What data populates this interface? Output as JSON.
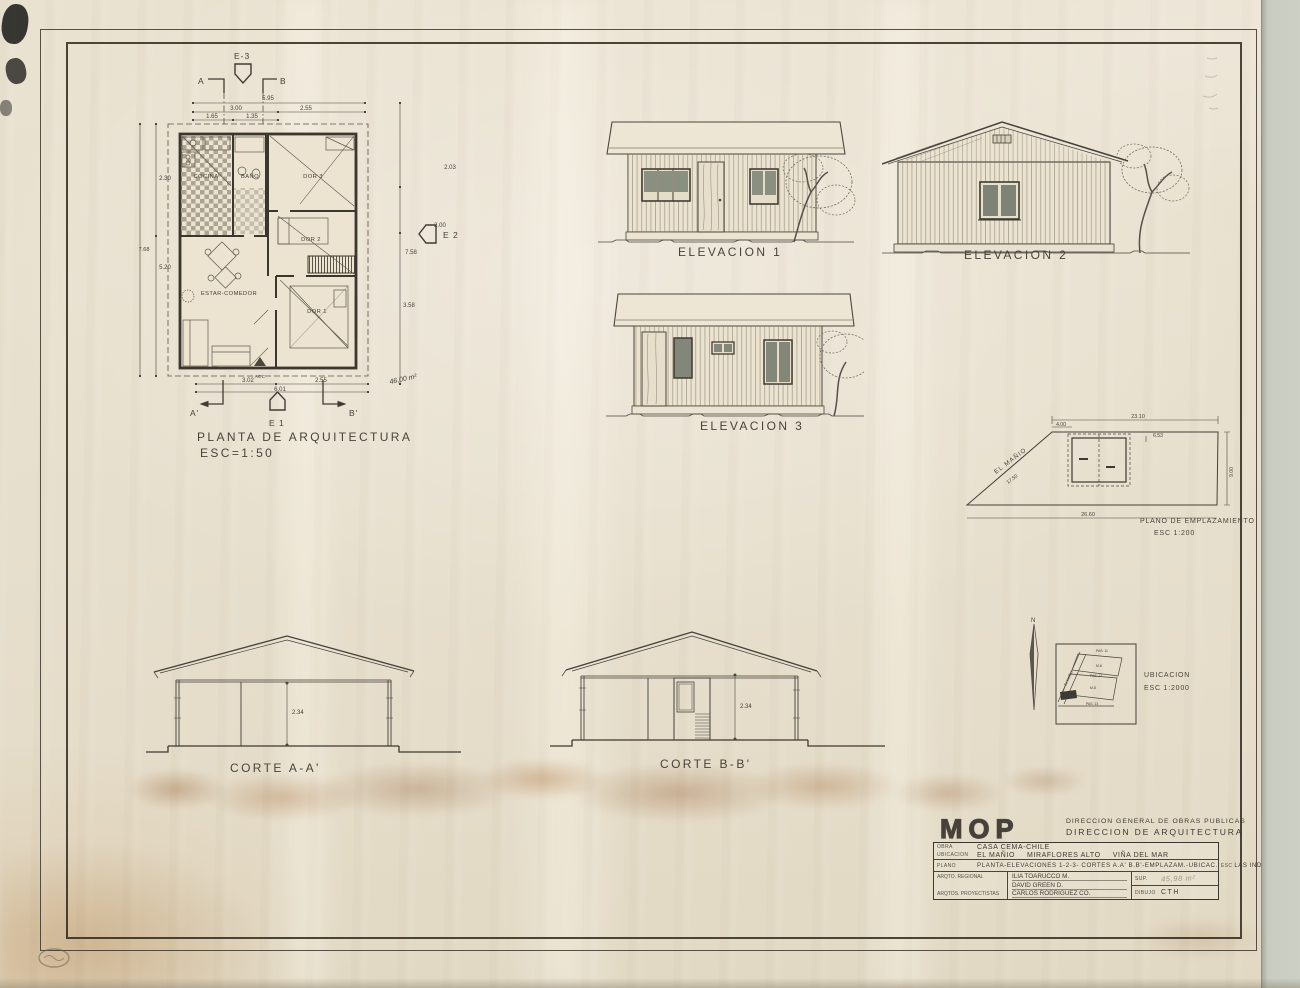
{
  "floor_plan": {
    "title": "PLANTA DE ARQUITECTURA",
    "scale": "ESC=1:50",
    "markers": {
      "e3": "E-3",
      "e2": "E 2",
      "e1": "E 1",
      "a": "A",
      "b": "B",
      "a2": "A'",
      "b2": "B'"
    },
    "rooms": {
      "cocina": "COCINA",
      "bano": "BAÑO",
      "dor3": "DOR 3",
      "dor2": "DOR 2",
      "dor1": "DOR 1",
      "estar": "ESTAR-COMEDOR",
      "acc": "ACC"
    },
    "dims": {
      "t_overall": "5.95",
      "t_left": "3.00",
      "t_right": "2.55",
      "t_s1": "1.65",
      "t_s2": "1.35",
      "l1": "2.30",
      "l2": "5.20",
      "l_overall": "7.68",
      "r1": "2.03",
      "r2": "2.00",
      "r_mid": "7.58",
      "r3": "3.58",
      "b1": "3.02",
      "b2": "2.55",
      "b_overall": "6.01"
    },
    "pencil_area": "46,00 m²"
  },
  "elevations": [
    {
      "label": "ELEVACION 1"
    },
    {
      "label": "ELEVACION 2"
    },
    {
      "label": "ELEVACION 3"
    }
  ],
  "sections": [
    {
      "label": "CORTE A-A'",
      "height": "2.34"
    },
    {
      "label": "CORTE B-B'",
      "height": "2.34"
    }
  ],
  "site_plan": {
    "title": "PLANO DE EMPLAZAMIENTO",
    "scale": "ESC 1:200",
    "street": "EL MAÑIO",
    "street_dim": "17.50",
    "dim_top": "23.10",
    "dim_seg": "4.00",
    "dim_house": "6.53",
    "dim_right": "9.00",
    "dim_bottom": "26.60"
  },
  "ubicacion": {
    "title": "UBICACION",
    "scale": "ESC 1:2000",
    "north": "N",
    "street": "EL MAÑIO",
    "pas11": "PAS. 11",
    "pas12": "PAS. 12",
    "pas13": "PAS. 13",
    "m6": "M-6",
    "m8": "M-8"
  },
  "title_block": {
    "logo": "MOP",
    "agency1": "DIRECCION GENERAL DE OBRAS PUBLICAS",
    "agency2": "DIRECCION DE ARQUITECTURA",
    "obra_label": "OBRA",
    "obra": "CASA CEMA-CHILE",
    "ubicacion_label": "UBICACION",
    "ubicacion_parts": [
      "EL MAÑIO",
      "MIRAFLORES ALTO",
      "VIÑA DEL MAR"
    ],
    "plano_label": "PLANO",
    "plano": "PLANTA-ELEVACIONES 1-2-3- CORTES A.A' B.B'-EMPLAZAM.-UBICAC.",
    "esc_label": "ESC",
    "esc": "LAS INDICADAS",
    "role1": "ARQTO. REGIONAL",
    "role2": "ARQTOS. PROYECTISTAS",
    "names": [
      "ILIA TOARUCCO M.",
      "DAVID GREEN D.",
      "CARLOS RODRIGUEZ CO."
    ],
    "sup_label": "SUP.",
    "sup": "45,98 m²",
    "dibujo_label": "DIBUJO",
    "dibujo": "CTH"
  }
}
